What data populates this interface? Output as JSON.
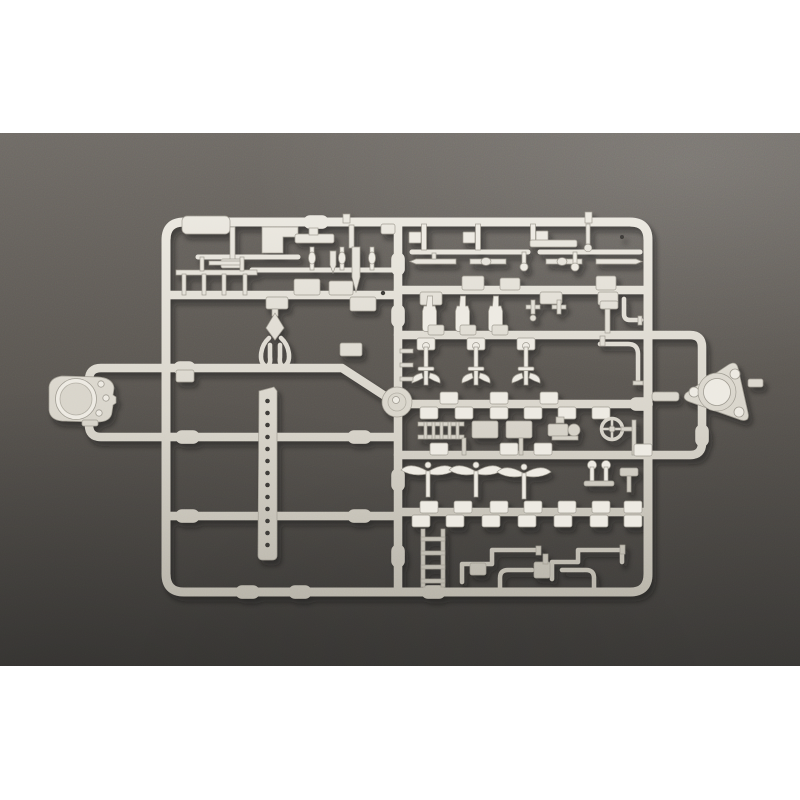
{
  "scene": {
    "kind": "product-photo",
    "subject": "injection-molded model kit sprue (parts tree) with many small ship detail parts",
    "background": "dark slate surface",
    "plastic_finish": "light warm grey styrene"
  },
  "colors": {
    "page-bg": "#ffffff",
    "bg-top": "#6e6a65",
    "bg-mid": "#5a5651",
    "bg-bottom": "#454340",
    "plastic-light": "#edeae2",
    "plastic-mid": "#d8d4ca",
    "plastic-dark": "#b1ada2",
    "plastic-edge": "#9d998f",
    "hole": "#3e3b37",
    "shadow": "#16140f"
  },
  "notable_parts": {
    "left_attachment": "gun-mount base with round drum",
    "right_attachment": "triangular mount base with round drum",
    "center": "round disc on hub",
    "middle_left": "drilled beam with row of holes",
    "others": [
      "railings",
      "ventilators",
      "anchors",
      "ladders",
      "valve wheel",
      "pipes",
      "davit",
      "masts"
    ]
  }
}
